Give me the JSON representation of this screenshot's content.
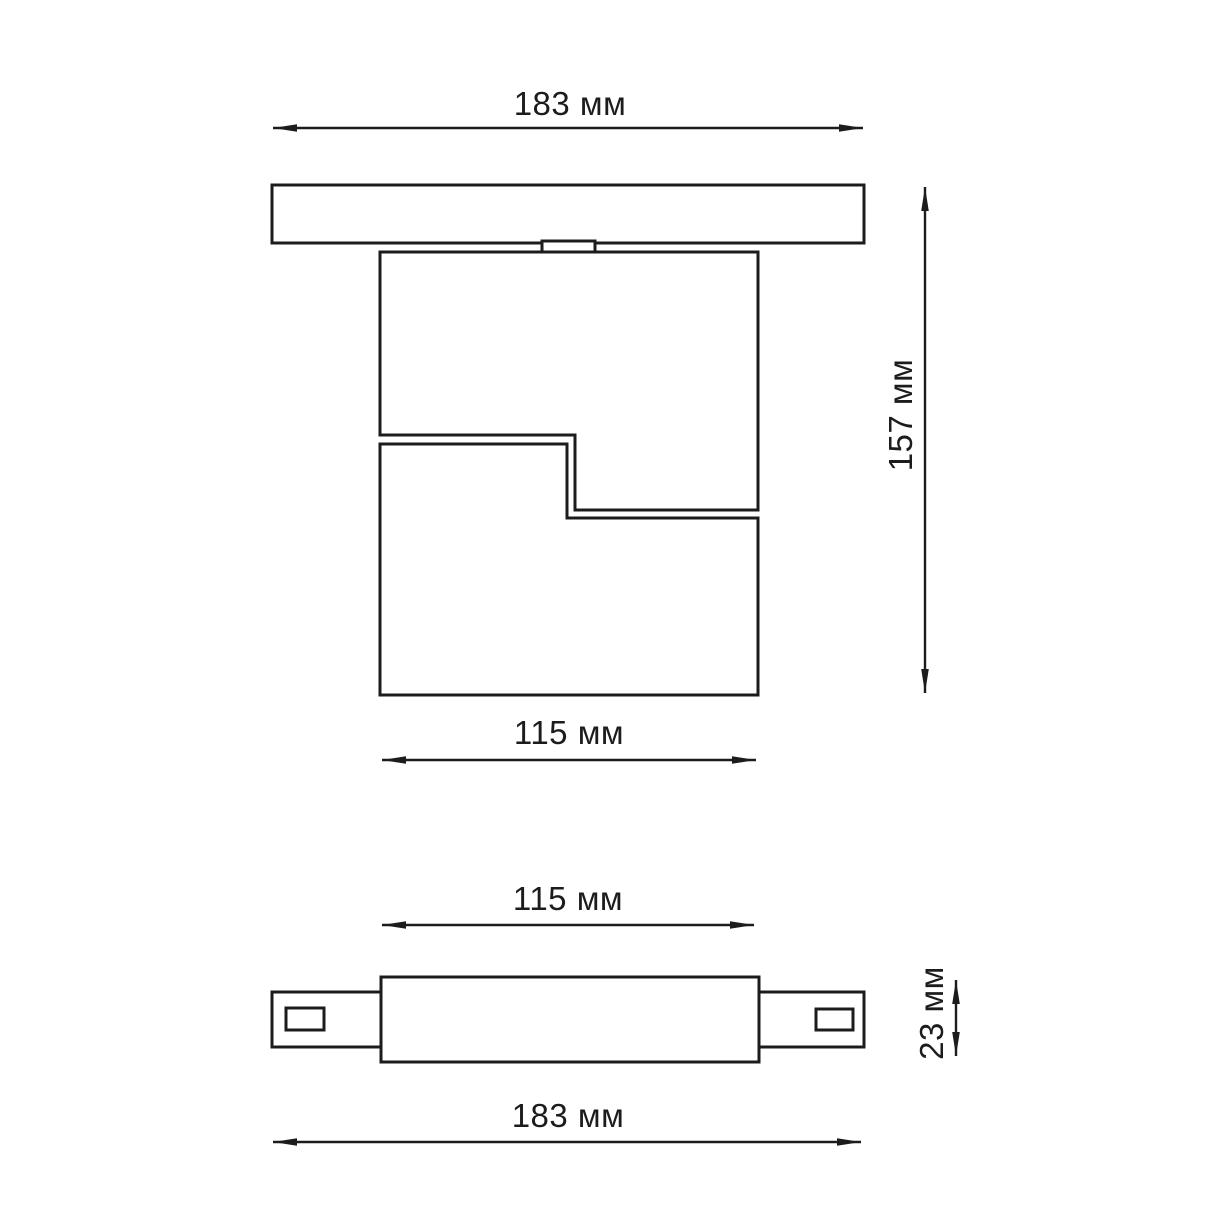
{
  "drawing": {
    "units": "мм",
    "colors": {
      "background": "#ffffff",
      "line": "#1c1c1c",
      "text": "#1c1c1c"
    }
  },
  "views": [
    {
      "id": "front-view",
      "parts": [
        "track-profile",
        "track-adapter",
        "fixture-head-upper",
        "fixture-head-lower"
      ],
      "dimensions": [
        {
          "id": "track-width",
          "value": 183,
          "unit": "мм",
          "label": "183 мм",
          "orientation": "horizontal"
        },
        {
          "id": "overall-height",
          "value": 157,
          "unit": "мм",
          "label": "157 мм",
          "orientation": "vertical"
        },
        {
          "id": "head-width",
          "value": 115,
          "unit": "мм",
          "label": "115 мм",
          "orientation": "horizontal"
        }
      ]
    },
    {
      "id": "bottom-view",
      "parts": [
        "body",
        "left-connector-tab",
        "right-connector-tab",
        "left-slot",
        "right-slot"
      ],
      "dimensions": [
        {
          "id": "body-width",
          "value": 115,
          "unit": "мм",
          "label": "115 мм",
          "orientation": "horizontal"
        },
        {
          "id": "body-depth",
          "value": 23,
          "unit": "мм",
          "label": "23 мм",
          "orientation": "vertical"
        },
        {
          "id": "overall-width",
          "value": 183,
          "unit": "мм",
          "label": "183 мм",
          "orientation": "horizontal"
        }
      ]
    }
  ]
}
